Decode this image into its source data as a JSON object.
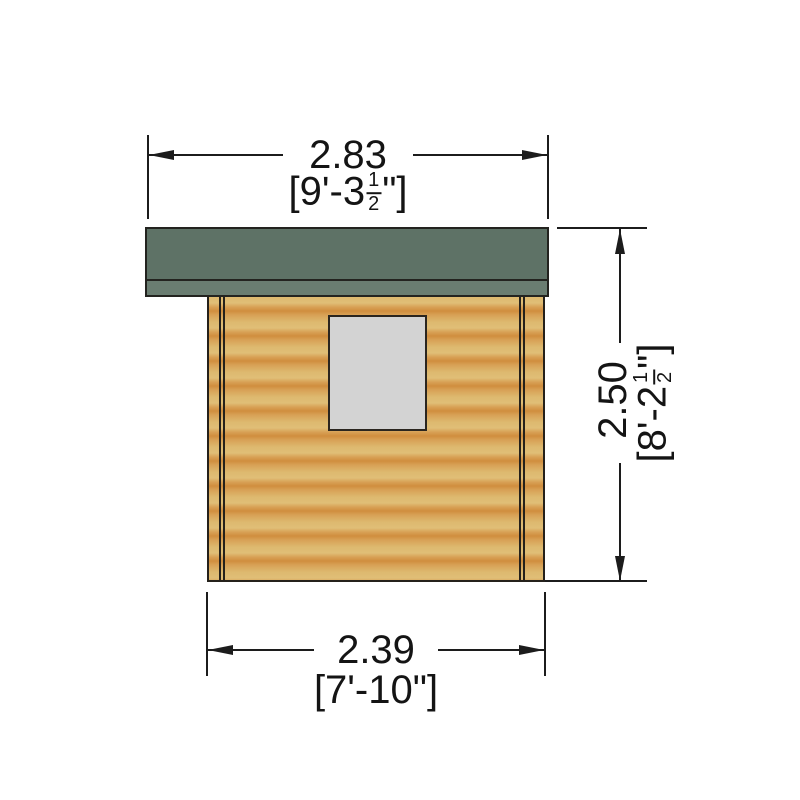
{
  "drawing": {
    "subject": "log-cabin-elevation",
    "colors": {
      "roof": "#5e7266",
      "roof_fascia": "#6a7d71",
      "wood_light": "#ddb96f",
      "wood_dark": "#d08e3e",
      "window": "#d3d3d3",
      "line": "#1c1c1c",
      "background": "#ffffff"
    }
  },
  "dimensions": {
    "top": {
      "metric": "2.83",
      "imperial_prefix": "[9'-3",
      "frac_n": "1",
      "frac_d": "2",
      "imperial_suffix": "\"]"
    },
    "right": {
      "metric": "2.50",
      "imperial_prefix": "[8'-2",
      "frac_n": "1",
      "frac_d": "2",
      "imperial_suffix": "\"]"
    },
    "bottom": {
      "metric": "2.39",
      "imperial_prefix": "[7'-10",
      "frac_n": "",
      "frac_d": "",
      "imperial_suffix": "\"]"
    }
  }
}
